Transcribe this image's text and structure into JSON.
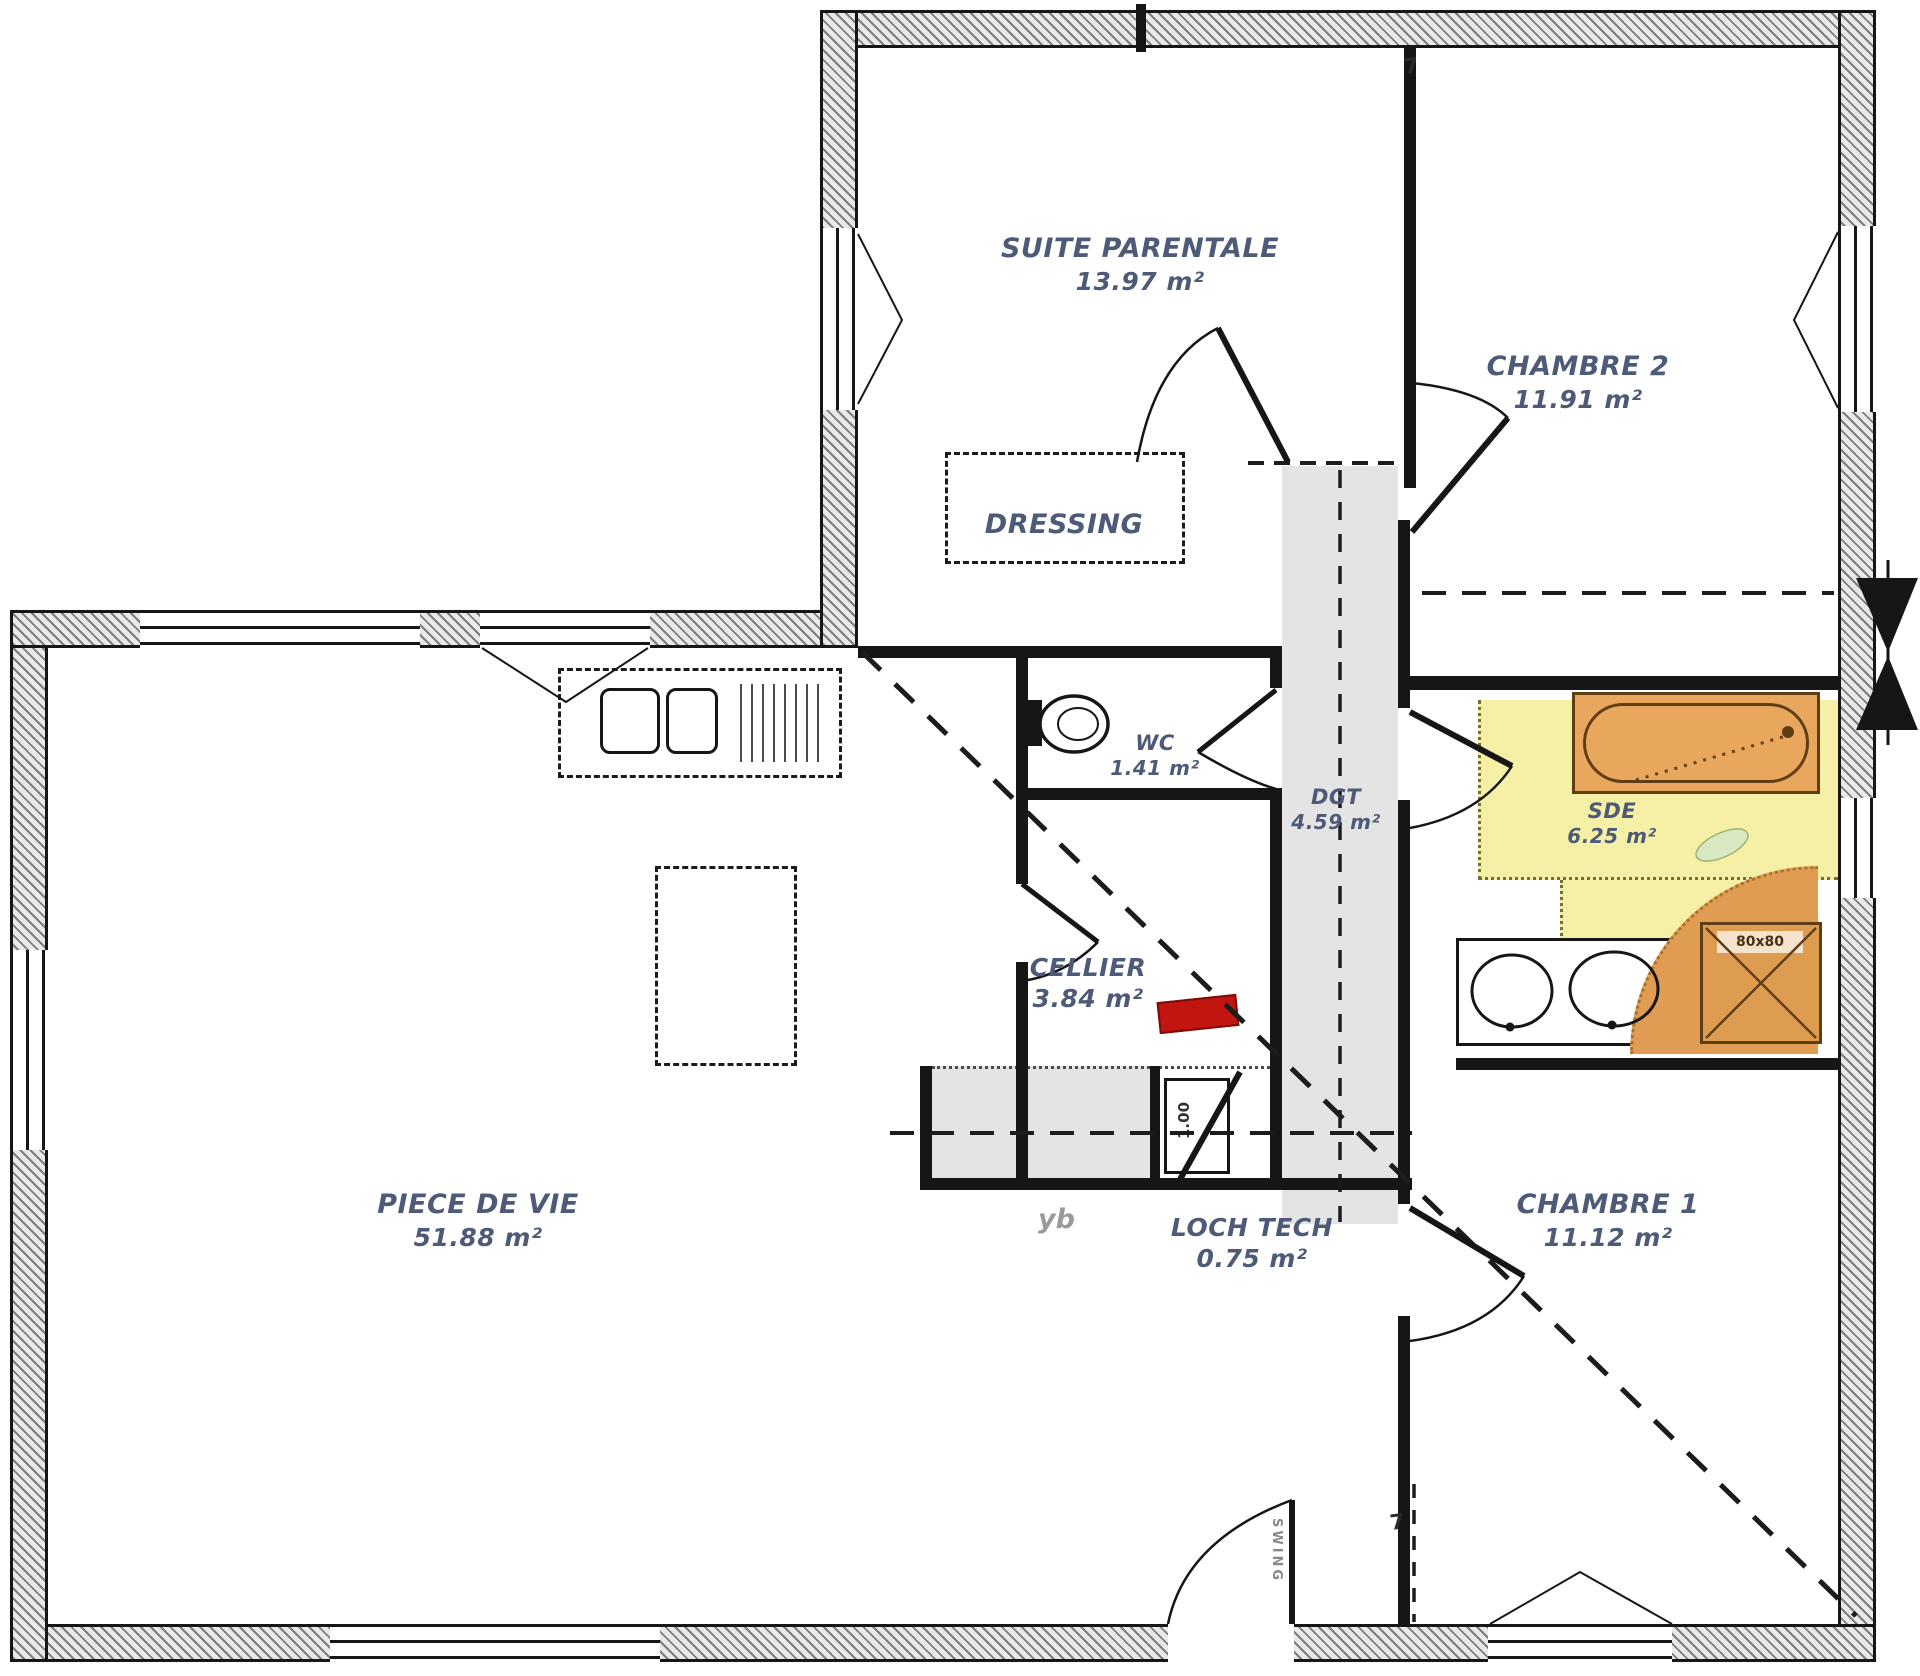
{
  "plan": {
    "title": "floor-plan",
    "rooms": [
      {
        "name": "SUITE PARENTALE",
        "area": "13.97 m²"
      },
      {
        "name": "CHAMBRE 2",
        "area": "11.91 m²"
      },
      {
        "name": "DRESSING",
        "area": ""
      },
      {
        "name": "WC",
        "area": "1.41 m²"
      },
      {
        "name": "DGT",
        "area": "4.59 m²"
      },
      {
        "name": "SDE",
        "area": "6.25 m²"
      },
      {
        "name": "CELLIER",
        "area": "3.84 m²"
      },
      {
        "name": "PIECE DE VIE",
        "area": "51.88 m²"
      },
      {
        "name": "LOCH TECH",
        "area": "0.75 m²"
      },
      {
        "name": "CHAMBRE 1",
        "area": "11.12 m²"
      }
    ],
    "annotations": {
      "shower_size": "80x80",
      "door_swing_label": "SWING",
      "watermark": "yb",
      "appliance_dim": "1.00",
      "dim_mark_top": "7",
      "dim_mark_bottom": "7"
    },
    "colors": {
      "label_text": "#4d5a78",
      "bathroom_highlight": "#f5f0a5",
      "fixture_orange": "#e09c52",
      "circulation_gray": "#e4e4e4",
      "wall_black": "#161616",
      "alert_red": "#c21510"
    }
  }
}
